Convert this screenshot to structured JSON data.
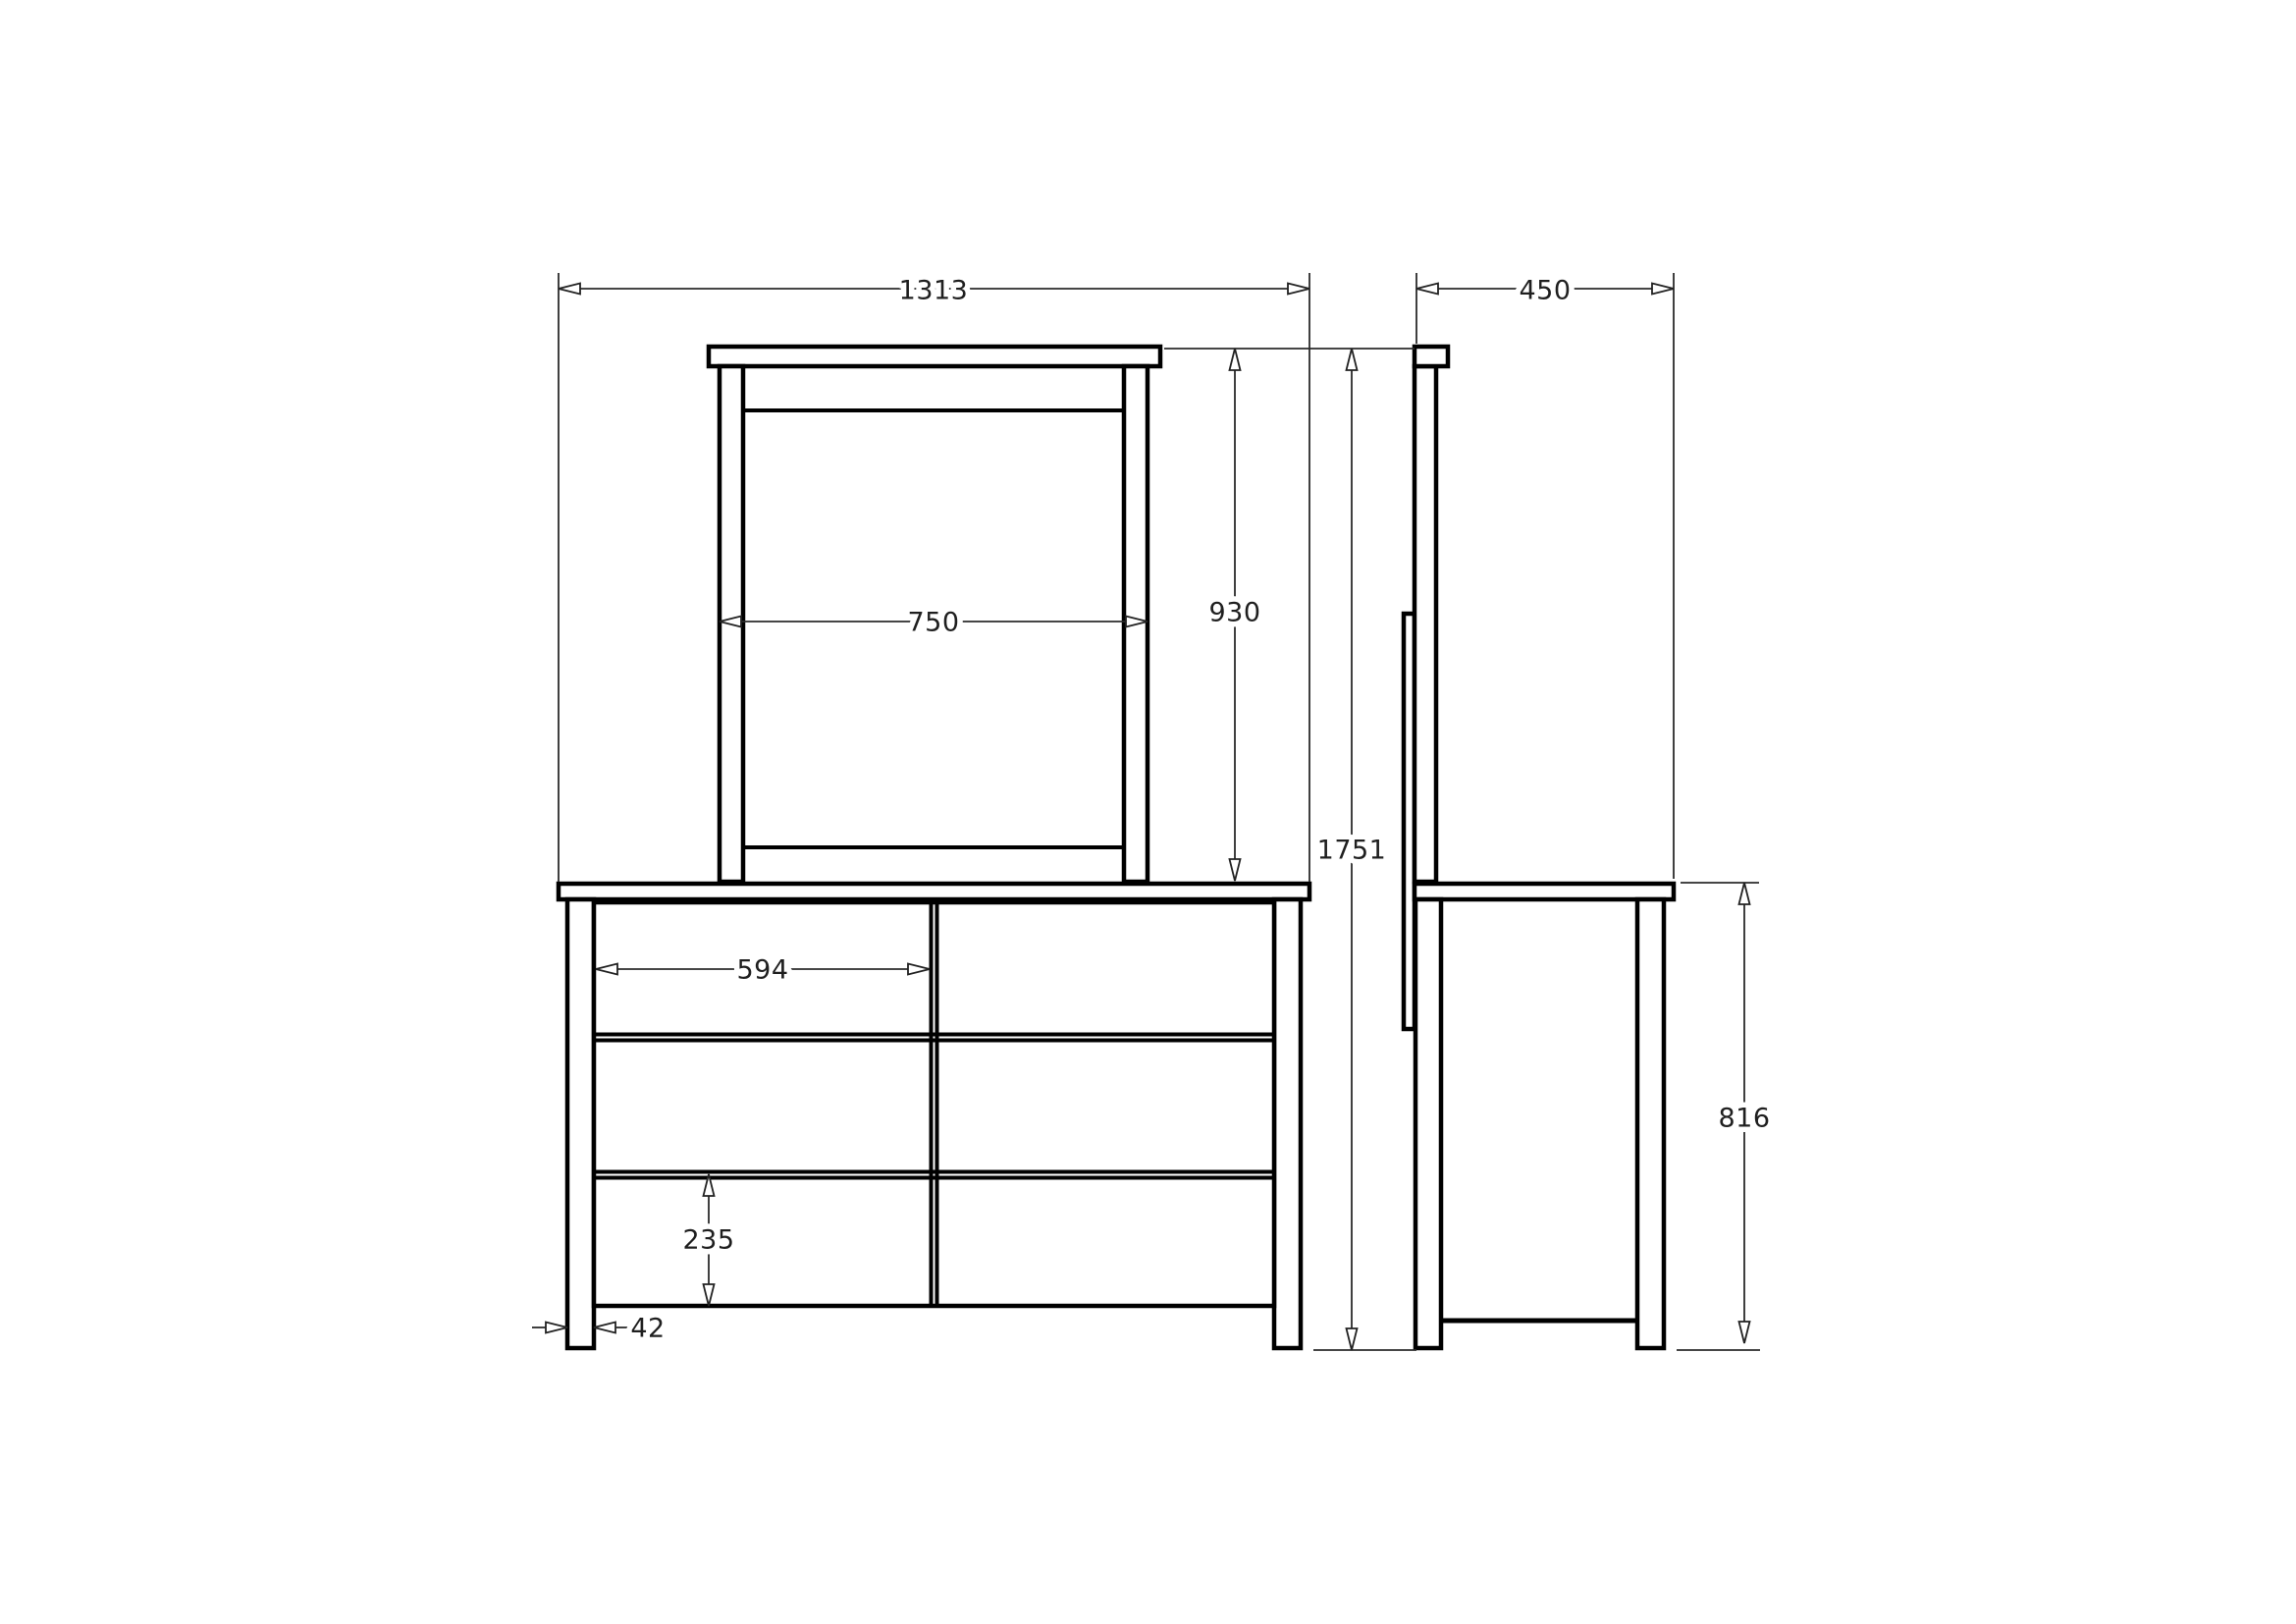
{
  "drawing": {
    "type": "furniture technical drawing",
    "subject": "dresser with mirror - front and side elevations",
    "units": "mm",
    "colors": {
      "outline": "#000000",
      "dimension_line": "#2b2b2b",
      "text": "#1f1f1f",
      "background": "#ffffff"
    },
    "views": [
      {
        "id": "front",
        "label": "front elevation"
      },
      {
        "id": "side",
        "label": "side elevation"
      }
    ],
    "dimensions": {
      "overall_width": "1313",
      "depth": "450",
      "mirror_width": "750",
      "mirror_height": "930",
      "overall_height": "1751",
      "drawer_width": "594",
      "drawer_height": "235",
      "leg_width": "42",
      "carcass_height": "816"
    }
  }
}
